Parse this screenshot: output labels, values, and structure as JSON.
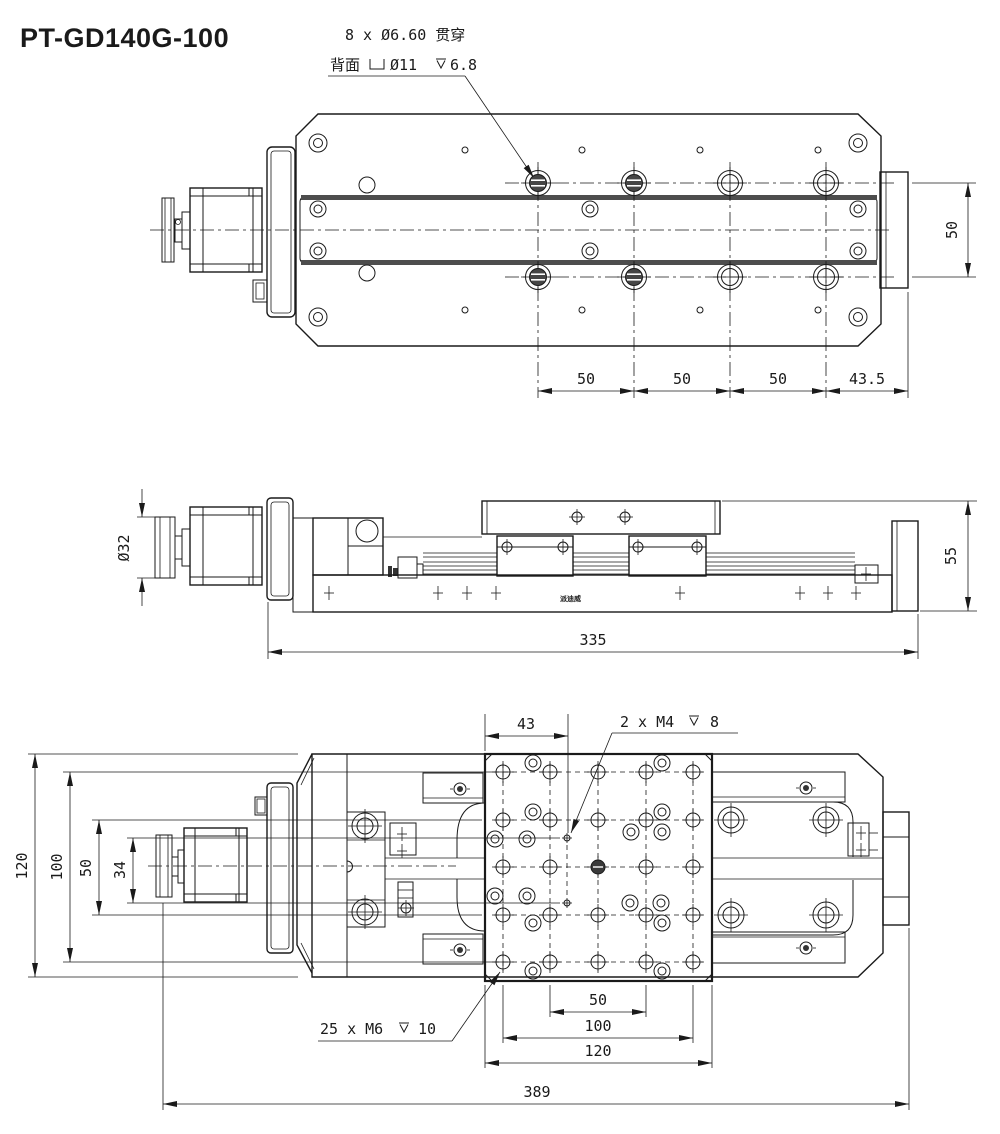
{
  "title": "PT-GD140G-100",
  "top_view": {
    "note_line1": "8 x Ø6.60 贯穿",
    "note_line2_prefix": "背面",
    "note_line2_dia": "Ø11",
    "note_line2_depth": "6.8",
    "dim_pitch_1": "50",
    "dim_pitch_2": "50",
    "dim_pitch_3": "50",
    "dim_end": "43.5",
    "dim_row_spacing": "50"
  },
  "side_view": {
    "dim_knob_dia": "Ø32",
    "dim_height": "55",
    "dim_length": "335",
    "brand_label": "派迪威"
  },
  "bottom_view": {
    "dim_offset": "43",
    "note_m4_label": "2 x M4",
    "note_m4_depth": "8",
    "note_m6_label": "25 x M6",
    "note_m6_depth": "10",
    "dim_grid_50": "50",
    "dim_grid_100": "100",
    "dim_table_120": "120",
    "dim_overall": "389",
    "dim_width_120": "120",
    "dim_width_100": "100",
    "dim_width_50": "50",
    "dim_width_34": "34"
  }
}
